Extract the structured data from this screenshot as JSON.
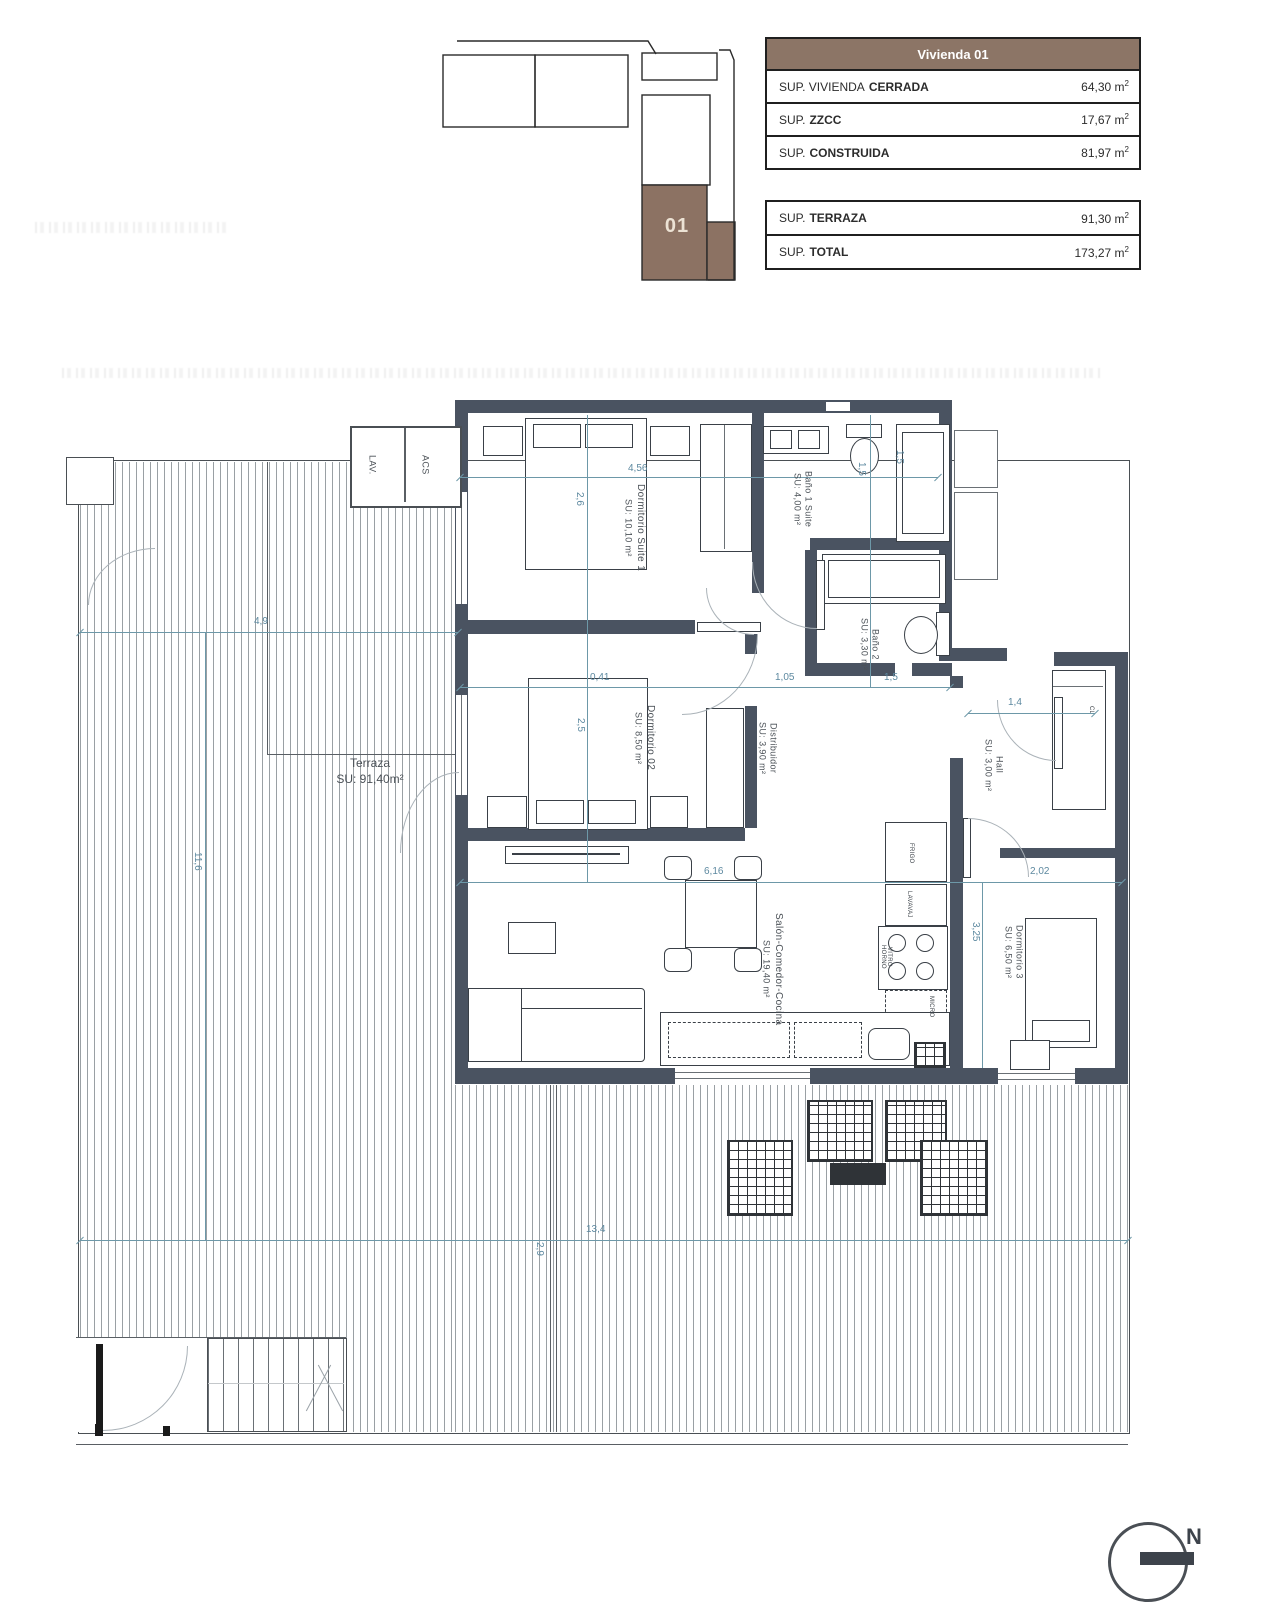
{
  "key_plan": {
    "unit_label": "01"
  },
  "summary_table": {
    "header": "Vivienda 01",
    "rows": [
      {
        "label": "SUP. VIVIENDA",
        "label_bold": "CERRADA",
        "value": "64,30",
        "unit": "m",
        "sup": "2"
      },
      {
        "label": "SUP.",
        "label_bold": "ZZCC",
        "value": "17,67",
        "unit": "m",
        "sup": "2"
      },
      {
        "label": "SUP.",
        "label_bold": "CONSTRUIDA",
        "value": "81,97",
        "unit": "m",
        "sup": "2"
      }
    ]
  },
  "totals_table": {
    "rows": [
      {
        "label": "SUP.",
        "label_bold": "TERRAZA",
        "value": "91,30",
        "unit": "m",
        "sup": "2"
      },
      {
        "label": "SUP.",
        "label_bold": "TOTAL",
        "value": "173,27",
        "unit": "m",
        "sup": "2"
      }
    ]
  },
  "plan": {
    "rooms": [
      {
        "name": "Dormitorio Suite 1",
        "area": "SU: 10,10 m²"
      },
      {
        "name": "Baño 1 Suite",
        "area": "SU: 4,00 m²"
      },
      {
        "name": "Baño 2",
        "area": "SU: 3,30 m²"
      },
      {
        "name": "Dormitorio 02",
        "area": "SU: 8,50 m²"
      },
      {
        "name": "Distribuidor",
        "area": "SU: 3,90 m²"
      },
      {
        "name": "Hall",
        "area": "SU: 3,00 m²"
      },
      {
        "name": "Dormitorio 3",
        "area": "SU: 6,50 m²"
      },
      {
        "name": "Salón-Comedor-Cocina",
        "area": "SU: 19,40 m²"
      },
      {
        "name": "Terraza",
        "area": "SU: 91,40m²"
      }
    ],
    "utility": {
      "lav": "LAV.",
      "acs": "ACS",
      "closet": "CL"
    },
    "kitchen": {
      "frigo": "FRIGO",
      "lavavaj": "LAVAVAJ",
      "vitro1": "VITRO",
      "vitro2": "HORNO",
      "micro": "MICRO"
    },
    "dimensions": [
      {
        "value": "4,56"
      },
      {
        "value": "2,6"
      },
      {
        "value": "1,5"
      },
      {
        "value": "1,5"
      },
      {
        "value": "4,9"
      },
      {
        "value": "0,41"
      },
      {
        "value": "1,05"
      },
      {
        "value": "1,5"
      },
      {
        "value": "1,4"
      },
      {
        "value": "2,5"
      },
      {
        "value": "6,16"
      },
      {
        "value": "2,02"
      },
      {
        "value": "3,25"
      },
      {
        "value": "11,6"
      },
      {
        "value": "13,4"
      },
      {
        "value": "2,9"
      }
    ]
  },
  "compass": {
    "north_label": "N"
  },
  "colors": {
    "accent_brown": "#8c7566",
    "wall": "#4a5361",
    "dimension": "#5d89a0"
  }
}
